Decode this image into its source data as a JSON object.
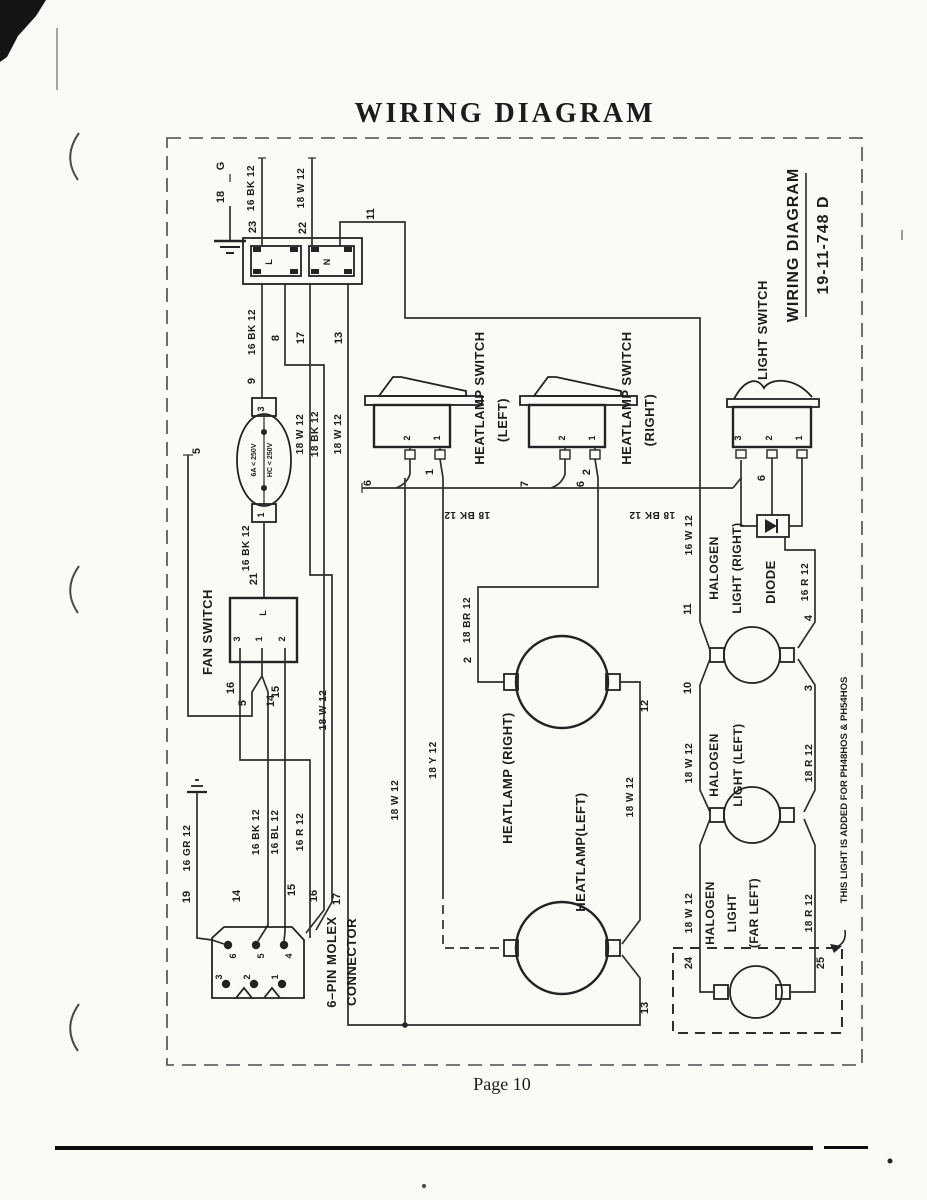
{
  "page": {
    "title": "WIRING DIAGRAM",
    "footer": "Page 10"
  },
  "titleblock": {
    "line1": "WIRING DIAGRAM",
    "line2": "19-11-748  D"
  },
  "components": {
    "heatlamp_switch_left": {
      "l1": "HEATLAMP SWITCH",
      "l2": "(LEFT)"
    },
    "heatlamp_switch_right": {
      "l1": "HEATLAMP SWITCH",
      "l2": "(RIGHT)"
    },
    "light_switch": "LIGHT SWITCH",
    "fan_switch": "FAN SWITCH",
    "diode": "DIODE",
    "molex": {
      "l1": "6–PIN MOLEX",
      "l2": "CONNECTOR"
    },
    "halogen_right": {
      "l1": "HALOGEN",
      "l2": "LIGHT (RIGHT)"
    },
    "halogen_left": {
      "l1": "HALOGEN",
      "l2": "LIGHT (LEFT)"
    },
    "halogen_far_left": {
      "l1": "HALOGEN",
      "l2": "LIGHT",
      "l3": "(FAR LEFT)"
    },
    "heatlamp_right": "HEATLAMP (RIGHT)",
    "heatlamp_left": "HEATLAMP(LEFT)",
    "fuse": {
      "l1": "6A < 250V",
      "l2": "HC < 250V"
    },
    "block_l": "L",
    "block_n": "N",
    "fan_l": "L",
    "note": "THIS LIGHT IS ADDED FOR PH48HOS & PH54HOS"
  },
  "wires": {
    "w16bk12": "16 BK 12",
    "w18w12": "18 W 12",
    "w16w12": "16 W 12",
    "w18bk12": "18 BK 12",
    "w18br12": "18 BR 12",
    "w18y12": "18 Y 12",
    "w16r12": "16 R 12",
    "w18r12": "18 R 12",
    "w16gr12": "16 GR 12",
    "w16bl12": "16 BL 12"
  },
  "nums": {
    "n1": "1",
    "n2": "2",
    "n3": "3",
    "n4": "4",
    "n5": "5",
    "n6": "6",
    "n7": "7",
    "n8": "8",
    "n9": "9",
    "n10": "10",
    "n11": "11",
    "n12": "12",
    "n13": "13",
    "n14": "14",
    "n15": "15",
    "n16": "16",
    "n17": "17",
    "n18": "18",
    "n19": "19",
    "n21": "21",
    "n22": "22",
    "n23": "23",
    "n24": "24",
    "n25": "25",
    "g": "G"
  }
}
